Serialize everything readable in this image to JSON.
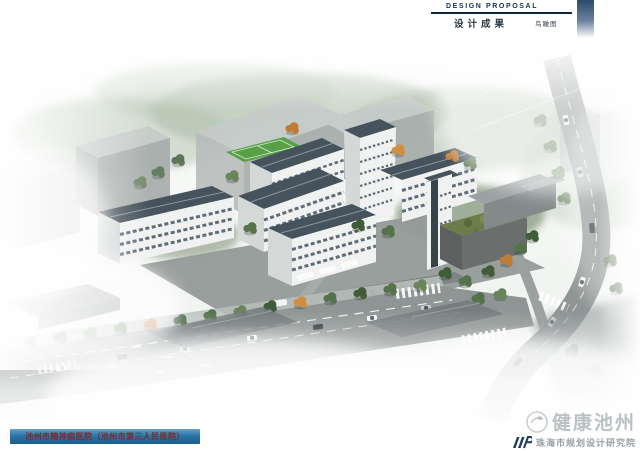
{
  "header": {
    "kicker": "DESIGN PROPOSAL",
    "title": "设计成果",
    "caption": "鸟瞰图",
    "accent_color": "#2c4a6a"
  },
  "footer": {
    "project_label": "池州市精神病医院（池州市第三人民医院）",
    "bar_color": "#2a74a6",
    "text_color": "#7e2a2e"
  },
  "watermark": {
    "brand": "健康池州",
    "institute": "珠海市规划设计研究院",
    "logo_color": "#1d3a5e"
  },
  "scene": {
    "colors": {
      "roof": "#46525c",
      "facade": "#f0f2f1",
      "side": "#d4d9d7",
      "window": "#5f6d7a",
      "road": "#8f9594",
      "field": "#57a047",
      "greenroof": "#6b7d4a",
      "massing_top": "#c6cbc9",
      "massing_front": "#a7adab",
      "massing_side": "#b8bdbb",
      "tree1": "#3f5d39",
      "tree2": "#54734a",
      "tree3": "#69855a",
      "autumn1": "#c07c36",
      "autumn2": "#d09044"
    }
  }
}
